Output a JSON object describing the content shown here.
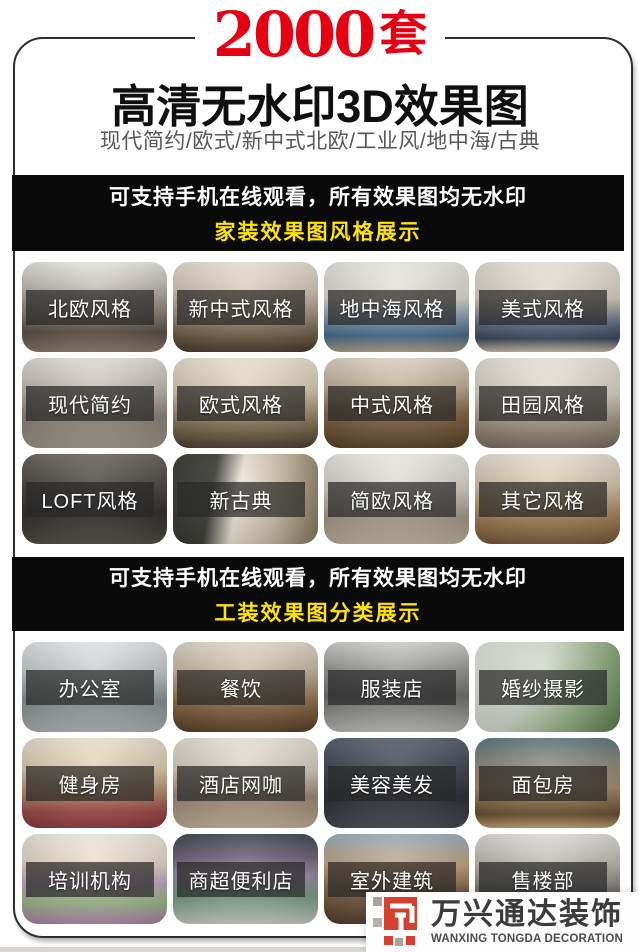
{
  "page": {
    "accent_red": "#e60012",
    "accent_yellow": "#ffe400",
    "banner_bg": "#0a0a0a",
    "frame_border": "#2e2e2e"
  },
  "header": {
    "count": "2000",
    "count_unit": "套",
    "title": "高清无水印3D效果图",
    "subtitle": "现代简约/欧式/新中式北欧/工业风/地中海/古典"
  },
  "banners": [
    {
      "line1": "可支持手机在线观看，所有效果图均无水印",
      "line2": "家装效果图风格展示"
    },
    {
      "line1": "可支持手机在线观看，所有效果图均无水印",
      "line2": "工装效果图分类展示"
    }
  ],
  "grids": [
    {
      "name": "home-decoration-styles",
      "items": [
        {
          "label": "北欧风格",
          "bg": "linear-gradient(180deg,#f0efec 0%,#c9c4bd 25%,#8e8378 55%,#5c5349 78%,#8f7f6b 100%)"
        },
        {
          "label": "新中式风格",
          "bg": "linear-gradient(180deg,#efe8db 0%,#d8cdbc 30%,#a2907a 60%,#6e5b45 85%,#4a3d2e 100%)"
        },
        {
          "label": "地中海风格",
          "bg": "linear-gradient(180deg,#f3f1ec 0%,#e0dcd2 40%,#7c98ad 65%,#4a6e8e 82%,#b3a58f 100%)"
        },
        {
          "label": "美式风格",
          "bg": "linear-gradient(180deg,#f1ece2 0%,#ddd3c2 40%,#5d6d87 70%,#3e4a60 85%,#cfc4b0 100%)"
        },
        {
          "label": "现代简约",
          "bg": "linear-gradient(180deg,#e9e7e3 0%,#c2bcb2 35%,#8d857a 65%,#a49a8c 100%)"
        },
        {
          "label": "欧式风格",
          "bg": "linear-gradient(180deg,#f2ead9 0%,#dccfb6 35%,#9d8868 65%,#4f4232 100%)"
        },
        {
          "label": "中式风格",
          "bg": "linear-gradient(180deg,#e5dccd 0%,#c5b59c 30%,#8a6c4a 60%,#5f452c 100%)"
        },
        {
          "label": "田园风格",
          "bg": "linear-gradient(180deg,#f0ebe2 0%,#ddd5c6 40%,#a89c88 70%,#7b7267 100%)"
        },
        {
          "label": "LOFT风格",
          "bg": "linear-gradient(180deg,#6e6a66 0%,#4a4642 35%,#2f2c29 65%,#55504a 100%)"
        },
        {
          "label": "新古典",
          "bg": "linear-gradient(100deg,#3c3c38 0%,#3c3c38 28%,#ece5d6 45%,#cdbfa6 70%,#8c7c62 100%)"
        },
        {
          "label": "简欧风格",
          "bg": "linear-gradient(180deg,#f4f2ee 0%,#ddd8cf 35%,#a79c8c 70%,#c4b8a4 100%)"
        },
        {
          "label": "其它风格",
          "bg": "linear-gradient(180deg,#efe9dd 0%,#d9c9ae 35%,#b08d5f 65%,#7a5c3a 100%)"
        }
      ]
    },
    {
      "name": "commercial-decoration-categories",
      "items": [
        {
          "label": "办公室",
          "bg": "linear-gradient(180deg,#eceff0 0%,#c6cbcd 35%,#8b9194 65%,#b4b9ba 100%)"
        },
        {
          "label": "餐饮",
          "bg": "linear-gradient(180deg,#e8e2d6 0%,#cdbfa8 30%,#96744d 65%,#5c432a 100%)"
        },
        {
          "label": "服装店",
          "bg": "linear-gradient(180deg,#d8d8d6 0%,#9b9b99 30%,#6f6f6d 60%,#c2c2c0 100%)"
        },
        {
          "label": "婚纱摄影",
          "bg": "linear-gradient(120deg,#eef0ea 0%,#d6dcd0 40%,#8fae7e 72%,#5e8452 100%)"
        },
        {
          "label": "健身房",
          "bg": "linear-gradient(180deg,#f3e9d8 0%,#e0cfae 35%,#b98f6e 60%,#a34d4a 82%,#8f3f40 100%)"
        },
        {
          "label": "酒店网咖",
          "bg": "linear-gradient(180deg,#efeae2 0%,#d9d0c2 35%,#a08a74 65%,#c8b59e 100%)"
        },
        {
          "label": "美容美发",
          "bg": "linear-gradient(180deg,#5c6470 0%,#3f4550 35%,#2a2e36 65%,#4b4f56 100%)"
        },
        {
          "label": "面包房",
          "bg": "linear-gradient(180deg,#5e7a80 0%,#8a8a80 25%,#a98f68 55%,#6f5334 85%,#caa87a 100%)"
        },
        {
          "label": "培训机构",
          "bg": "linear-gradient(180deg,#f6f0e6 0%,#eadfce 30%,#c7a9c0 55%,#9ec08a 75%,#b785b0 100%)"
        },
        {
          "label": "商超便利店",
          "bg": "linear-gradient(180deg,#3f4a52 0%,#6d5f78 25%,#9b8aa8 45%,#77a087 70%,#cfd2cc 100%)"
        },
        {
          "label": "室外建筑",
          "bg": "linear-gradient(180deg,#9db4c4 0%,#c8a67e 35%,#8a6a4c 60%,#54402e 100%)"
        },
        {
          "label": "售楼部",
          "bg": "linear-gradient(180deg,#e8e6e2 0%,#bcb8b2 35%,#6f6c68 70%,#99938c 100%)"
        }
      ]
    }
  ],
  "logo": {
    "cn": "万兴通达装饰",
    "en": "WANXING TONGDA DECORATION",
    "mark_red": "#d6402e",
    "mark_gray": "#a8a5a0"
  }
}
